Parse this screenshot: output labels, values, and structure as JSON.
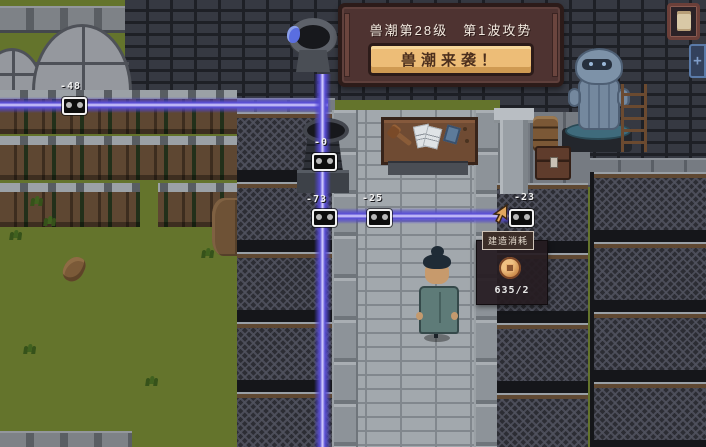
{
  "banner": {
    "title": "兽潮第28级　第1波攻势",
    "button_label": "兽潮来袭！"
  },
  "tooltip": {
    "header": "建造消耗",
    "icon": "coin-icon",
    "cost_value": "635/2"
  },
  "damage_numbers": [
    {
      "value": "-48"
    },
    {
      "value": "-0"
    },
    {
      "value": "-73"
    },
    {
      "value": "-25"
    },
    {
      "value": "-23"
    }
  ],
  "hud": {
    "top_right_icons": [
      "scroll-icon",
      "plus-panel-icon"
    ],
    "plus_glyph": "+"
  },
  "scene": {
    "character": "villager-blue-robe",
    "projectile_icon": "beam-projectile-icon",
    "cursor": "game-cursor-arrow"
  },
  "colors": {
    "beam_core": "#d8d2ff",
    "beam_mid": "#5a4fd6",
    "banner_bg": "#4e3331",
    "button_bg": "#edbd77",
    "tooltip_bg": "#261c21",
    "grass": "#64742c",
    "path": "#a2a8ad",
    "wall_brick": "#363942",
    "coin": "#d0904f"
  }
}
